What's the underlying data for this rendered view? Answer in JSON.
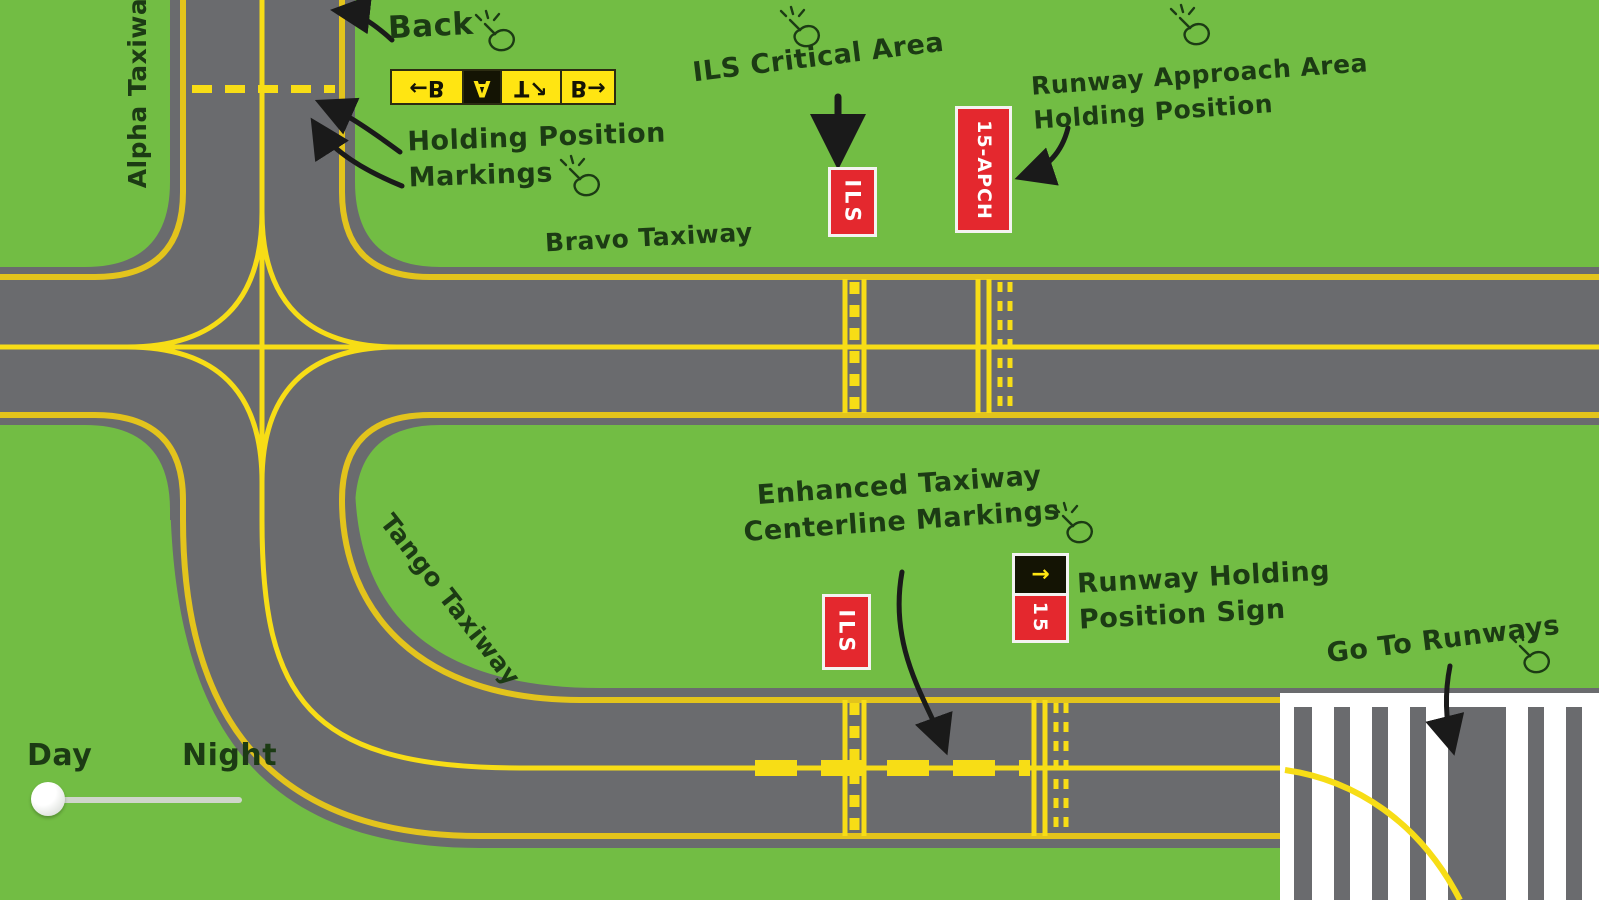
{
  "colors": {
    "grass_green": "#72BD44",
    "pavement_gray": "#6A6B6E",
    "edge_line_yellow": "#E3C41C",
    "centerline_yellow": "#F7DD16",
    "sign_red": "#E4282E",
    "sign_yellow": "#FFE512",
    "sign_black": "#141404",
    "ink_dark_green": "#1C3B14",
    "runway_white": "#FFFFFF"
  },
  "annotations": {
    "back": "Back",
    "holding_line1": "Holding Position",
    "holding_line2": "Markings",
    "ils_critical": "ILS Critical Area",
    "approach_line1": "Runway Approach Area",
    "approach_line2": "Holding Position",
    "enhanced_line1": "Enhanced Taxiway",
    "enhanced_line2": "Centerline Markings",
    "holding_sign_line1": "Runway Holding",
    "holding_sign_line2": "Position Sign",
    "go_to_runways": "Go To Runways"
  },
  "taxiways": {
    "alpha": "Alpha Taxiway",
    "bravo": "Bravo Taxiway",
    "tango": "Tango Taxiway"
  },
  "signs": {
    "direction": {
      "note": "letters drawn inverted on the sign art",
      "panels": [
        {
          "text": "←B",
          "style": "yellow"
        },
        {
          "text": "A",
          "style": "black"
        },
        {
          "text": "T↗",
          "style": "yellow"
        },
        {
          "text": "B→",
          "style": "yellow"
        }
      ]
    },
    "ils_upper": {
      "text": "ILS"
    },
    "approach_holding": {
      "text": "15-APCH"
    },
    "ils_lower": {
      "text": "ILS"
    },
    "runway_holding": {
      "arrow": "→",
      "number": "15"
    }
  },
  "slider": {
    "left_label": "Day",
    "right_label": "Night",
    "value": "Day"
  }
}
